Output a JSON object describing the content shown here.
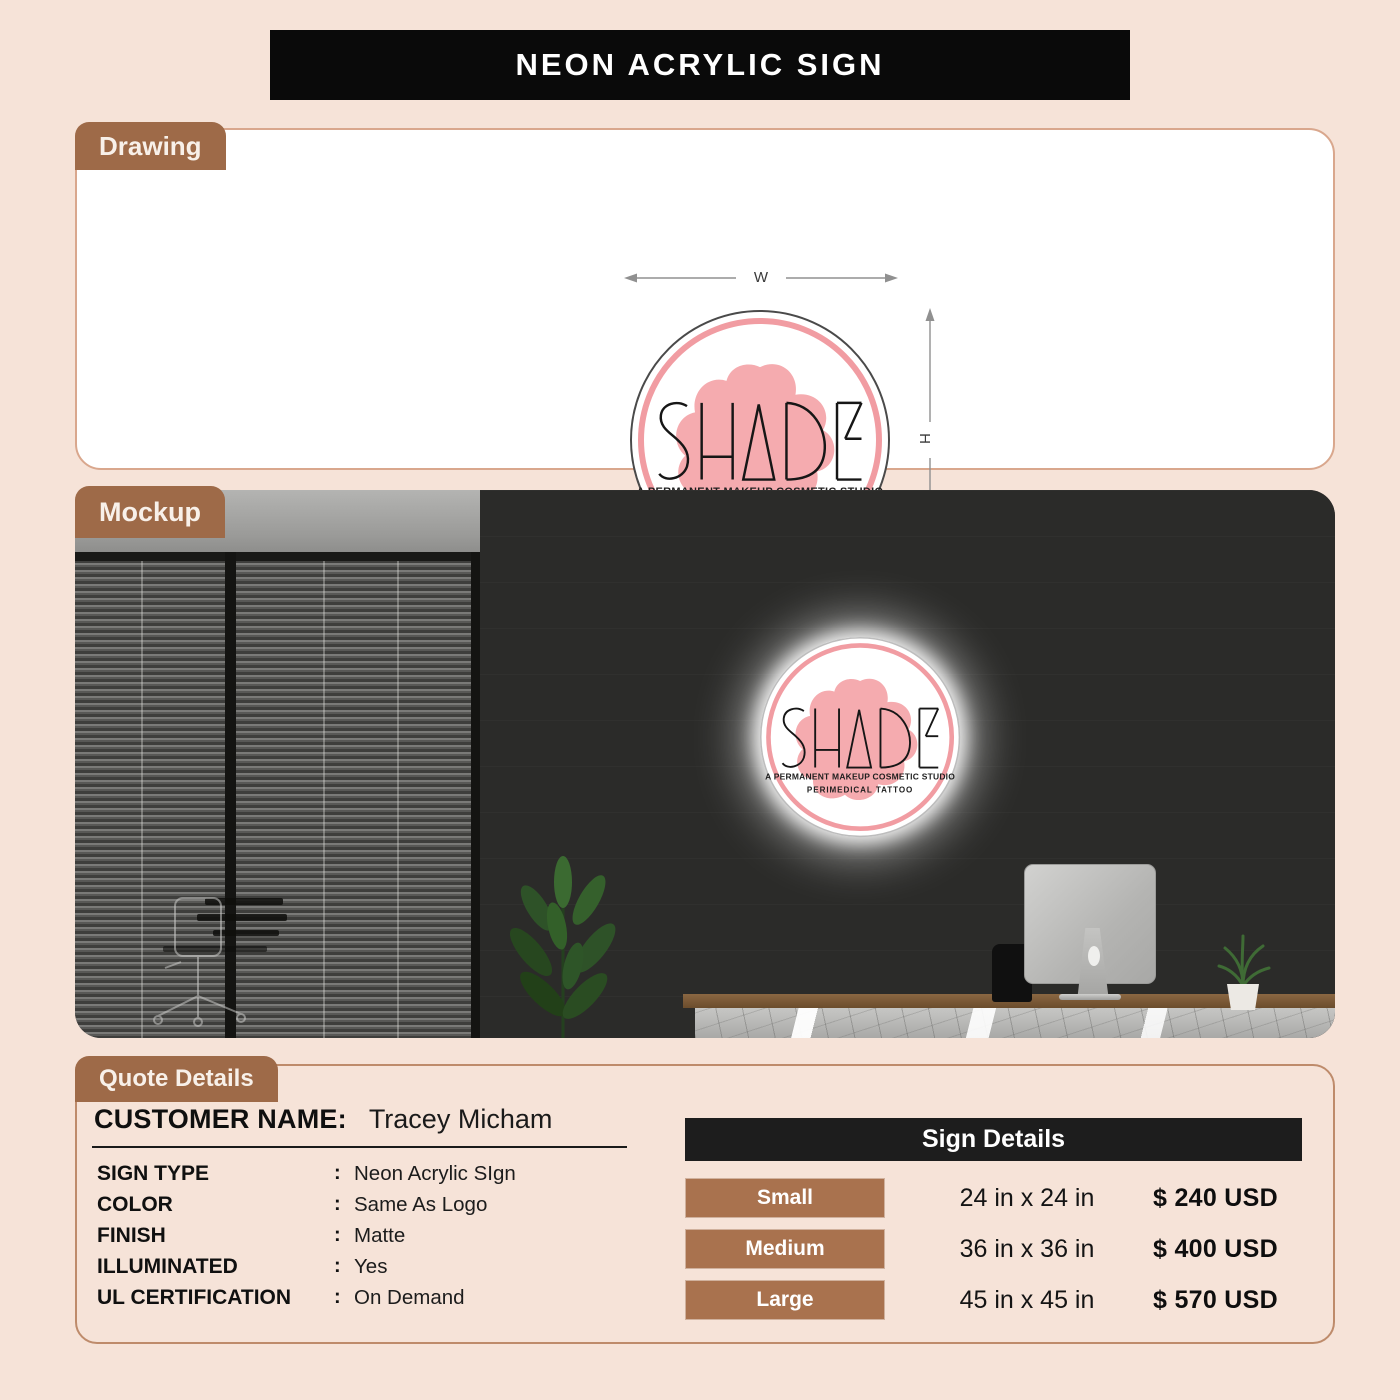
{
  "page": {
    "title": "NEON ACRYLIC SIGN"
  },
  "sections": {
    "drawing_label": "Drawing",
    "mockup_label": "Mockup",
    "quote_label": "Quote Details"
  },
  "logo": {
    "brand": "SHADE",
    "tagline1": "A PERMANENT MAKEUP COSMETIC STUDIO",
    "tagline2": "PERIMEDICAL TATTOO"
  },
  "drawing": {
    "width_label": "W",
    "height_label": "H"
  },
  "quote": {
    "customer_label": "CUSTOMER NAME:",
    "customer_name": "Tracey Micham",
    "colon": ":",
    "specs": [
      {
        "label": "SIGN TYPE",
        "value": "Neon Acrylic SIgn"
      },
      {
        "label": "COLOR",
        "value": "Same As Logo"
      },
      {
        "label": "FINISH",
        "value": "Matte"
      },
      {
        "label": "ILLUMINATED",
        "value": "Yes"
      },
      {
        "label": "UL CERTIFICATION",
        "value": "On Demand"
      }
    ],
    "sign_details": {
      "title": "Sign Details",
      "rows": [
        {
          "size": "Small",
          "dimensions": "24 in x 24 in",
          "price": "$ 240 USD"
        },
        {
          "size": "Medium",
          "dimensions": "36 in x 36 in",
          "price": "$ 400 USD"
        },
        {
          "size": "Large",
          "dimensions": "45 in x 45 in",
          "price": "$ 570 USD"
        }
      ]
    }
  },
  "colors": {
    "page_background": "#F6E3D8",
    "accent_brown": "#9E6A48",
    "button_brown": "#A9724E",
    "banner_black": "#0A0A0A",
    "table_header_dark": "#1D1D1D",
    "logo_ring_pink": "#F19CA2",
    "logo_blob_pink": "#F5ABAF",
    "mockup_wall": "#2B2B29"
  }
}
